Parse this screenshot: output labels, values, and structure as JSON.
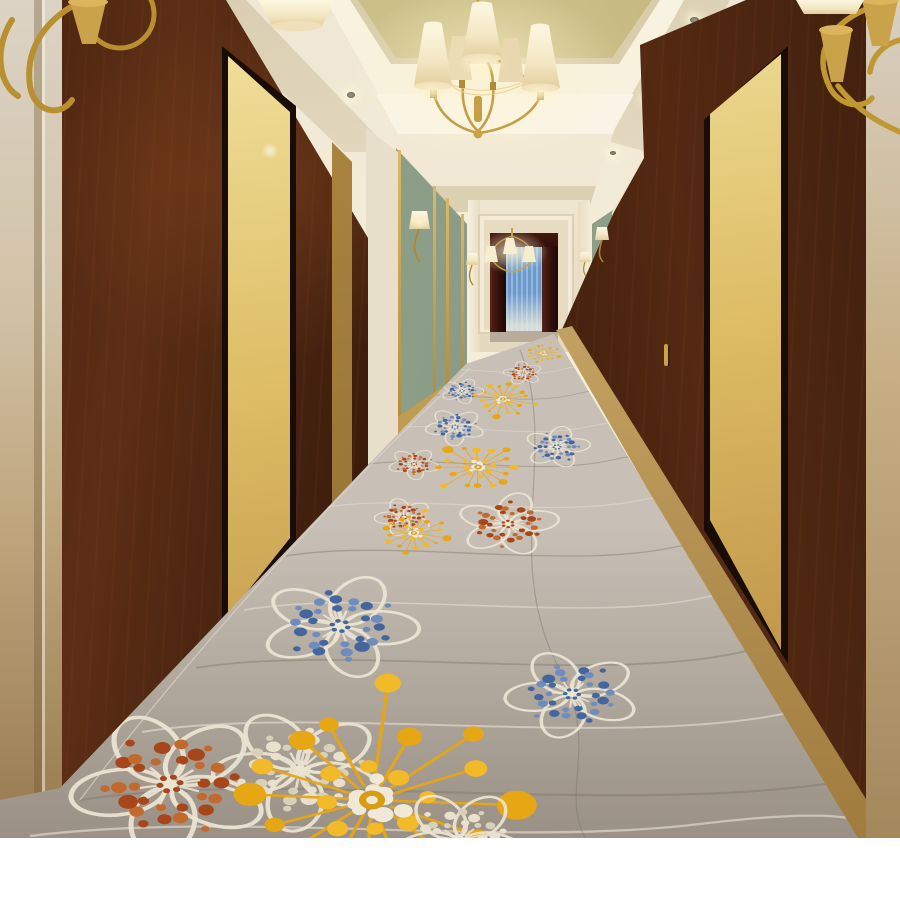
{
  "caption": {
    "label": "编号:Y2465-D4",
    "product_code": "Y2465-D4"
  },
  "photo": {
    "room_number": "08"
  },
  "colorways": {
    "swatches": [
      {
        "name": "cream",
        "hex": "#f2ebc7",
        "row": 1,
        "col": 1
      },
      {
        "name": "golden-yellow",
        "hex": "#eaad1c",
        "row": 1,
        "col": 2
      },
      {
        "name": "taupe",
        "hex": "#ae9f95",
        "row": 1,
        "col": 3
      },
      {
        "name": "warm-gray",
        "hex": "#918c89",
        "row": 1,
        "col": 4
      },
      {
        "name": "rust",
        "hex": "#b45a20",
        "row": 2,
        "col": 3
      },
      {
        "name": "steel-blue",
        "hex": "#6b86a5",
        "row": 2,
        "col": 4
      }
    ]
  },
  "palette": {
    "carpet_base": "#aba196",
    "carpet_line_light": "#ded7ca",
    "carpet_line_dark": "#7b7268",
    "flower_yellow": "#e7a614",
    "flower_yellow_light": "#f2ba28",
    "flower_rust": "#a8461b",
    "flower_rust_light": "#c26a2e",
    "flower_blue": "#44669f",
    "flower_blue_light": "#6e8cbe",
    "flower_cream": "#ece5d4",
    "wood": "#31180b",
    "brass": "#c59f45",
    "sage_wall": "#8ba089",
    "gold_ceiling": "#bfb37c",
    "curtain_blue": "#7fa9d8",
    "drape_maroon": "#401a14",
    "wall_cream": "#ddd3c2"
  }
}
